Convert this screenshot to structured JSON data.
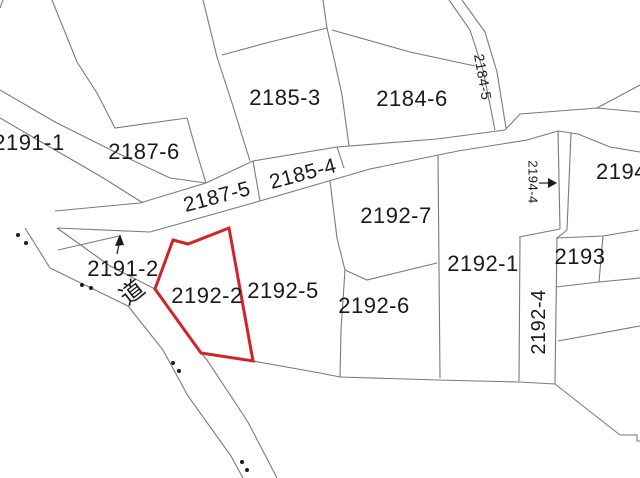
{
  "map": {
    "type": "cadastral-parcel-map",
    "background": "#ffffff",
    "line_color": "#7a7a7a",
    "dot_color": "#1b1b1b",
    "label_color": "#1a1a1a",
    "highlight_color": "#d2232a",
    "highlighted_parcel": "2192-2",
    "road_label": "道",
    "parcels": [
      {
        "label": "2191-1",
        "x": 29,
        "y": 143,
        "rot": 0,
        "size": 22,
        "anchor": "center"
      },
      {
        "label": "2187-6",
        "x": 144,
        "y": 152,
        "rot": 0,
        "size": 22,
        "anchor": "center"
      },
      {
        "label": "2185-3",
        "x": 285,
        "y": 98,
        "rot": 0,
        "size": 22,
        "anchor": "center"
      },
      {
        "label": "2184-6",
        "x": 412,
        "y": 99,
        "rot": 0,
        "size": 22,
        "anchor": "center"
      },
      {
        "label": "2187-5",
        "x": 217,
        "y": 197,
        "rot": -15,
        "size": 21,
        "anchor": "center"
      },
      {
        "label": "2185-4",
        "x": 303,
        "y": 174,
        "rot": -15,
        "size": 21,
        "anchor": "center"
      },
      {
        "label": "2184-5",
        "x": 483,
        "y": 77,
        "rot": 80,
        "size": 14,
        "anchor": "center"
      },
      {
        "label": "2194-4",
        "x": 533,
        "y": 182,
        "rot": 90,
        "size": 13,
        "anchor": "center"
      },
      {
        "label": "2194-",
        "x": 596,
        "y": 172,
        "rot": 0,
        "size": 22,
        "anchor": "left"
      },
      {
        "label": "2192-7",
        "x": 396,
        "y": 216,
        "rot": 0,
        "size": 22,
        "anchor": "center"
      },
      {
        "label": "2192-1",
        "x": 483,
        "y": 264,
        "rot": 0,
        "size": 22,
        "anchor": "center"
      },
      {
        "label": "2193",
        "x": 580,
        "y": 257,
        "rot": 0,
        "size": 22,
        "anchor": "center"
      },
      {
        "label": "2192-4",
        "x": 539,
        "y": 322,
        "rot": -90,
        "size": 20,
        "anchor": "center"
      },
      {
        "label": "2192-2",
        "x": 207,
        "y": 296,
        "rot": 0,
        "size": 22,
        "anchor": "center"
      },
      {
        "label": "2192-5",
        "x": 283,
        "y": 291,
        "rot": 0,
        "size": 22,
        "anchor": "center"
      },
      {
        "label": "2192-6",
        "x": 374,
        "y": 306,
        "rot": 0,
        "size": 22,
        "anchor": "center"
      },
      {
        "label": "2191-2",
        "x": 123,
        "y": 269,
        "rot": 0,
        "size": 22,
        "anchor": "center"
      },
      {
        "label": "道",
        "x": 133,
        "y": 293,
        "rot": -38,
        "size": 24,
        "anchor": "center"
      }
    ]
  }
}
